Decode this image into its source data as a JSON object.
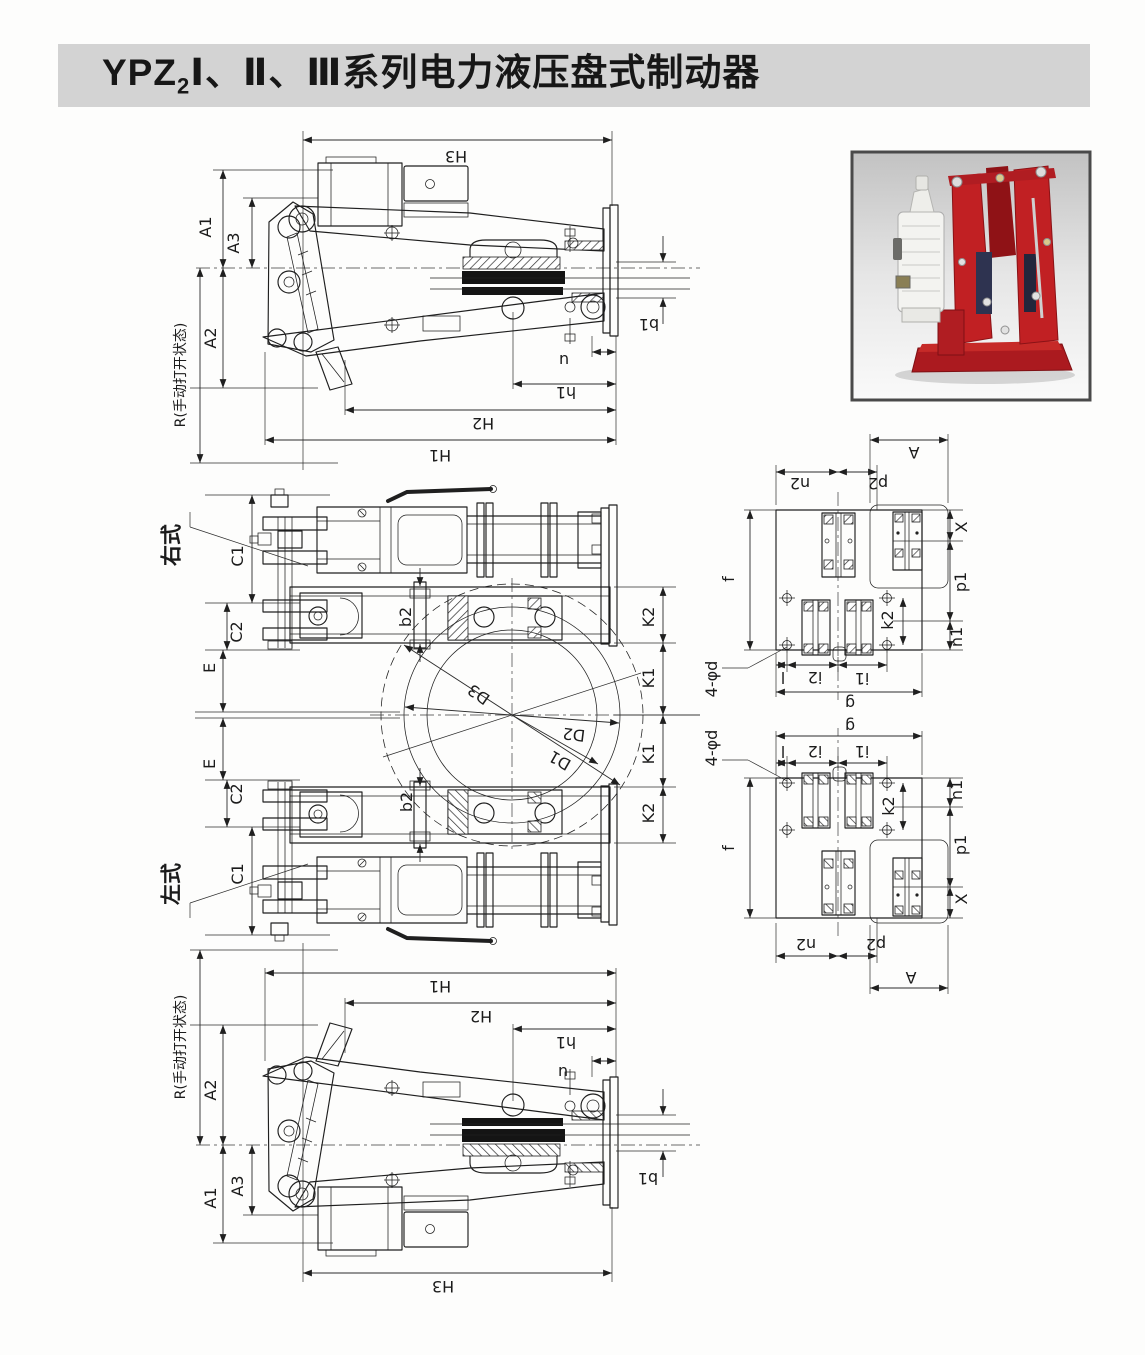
{
  "page": {
    "title_prefix": "YPZ",
    "title_sub": "2",
    "title_suffix": "Ⅰ、Ⅱ、Ⅲ系列电力液压盘式制动器"
  },
  "colors": {
    "title_bar_bg": "#d3d3d3",
    "line_color": "#2b2b2b",
    "brake_red": "#c12023",
    "photo_bg_top": "#c2c2c2"
  },
  "photo": {
    "description": "电力液压盘式制动器产品照片"
  },
  "labels": [
    {
      "t": "H3",
      "x": 456,
      "y": 156,
      "r": 180
    },
    {
      "t": "A1",
      "x": 206,
      "y": 227,
      "r": -90
    },
    {
      "t": "A3",
      "x": 234,
      "y": 243,
      "r": -90
    },
    {
      "t": "A2",
      "x": 211,
      "y": 338,
      "r": -90
    },
    {
      "t": "R(手动打开状态)",
      "x": 181,
      "y": 375,
      "r": -90,
      "s": 14
    },
    {
      "t": "b1",
      "x": 649,
      "y": 324,
      "r": 180
    },
    {
      "t": "u",
      "x": 564,
      "y": 360,
      "r": 180
    },
    {
      "t": "h1",
      "x": 566,
      "y": 392,
      "r": 180
    },
    {
      "t": "H2",
      "x": 483,
      "y": 423,
      "r": 180
    },
    {
      "t": "H1",
      "x": 440,
      "y": 455,
      "r": 180
    },
    {
      "t": "右式",
      "x": 172,
      "y": 545,
      "r": -90,
      "s": 21,
      "b": 1
    },
    {
      "t": "C1",
      "x": 238,
      "y": 556,
      "r": -90
    },
    {
      "t": "C2",
      "x": 237,
      "y": 632,
      "r": -90
    },
    {
      "t": "E",
      "x": 210,
      "y": 668,
      "r": -90
    },
    {
      "t": "b2",
      "x": 406,
      "y": 617,
      "r": -90
    },
    {
      "t": "K2",
      "x": 649,
      "y": 617,
      "r": -90
    },
    {
      "t": "K1",
      "x": 649,
      "y": 678,
      "r": -90
    },
    {
      "t": "D3",
      "x": 479,
      "y": 694,
      "r": 215
    },
    {
      "t": "D2",
      "x": 574,
      "y": 734,
      "r": 187
    },
    {
      "t": "D1",
      "x": 560,
      "y": 760,
      "r": 210
    },
    {
      "t": "K1",
      "x": 649,
      "y": 754,
      "r": -90
    },
    {
      "t": "K2",
      "x": 649,
      "y": 813,
      "r": -90
    },
    {
      "t": "E",
      "x": 210,
      "y": 764,
      "r": -90
    },
    {
      "t": "C2",
      "x": 237,
      "y": 794,
      "r": -90
    },
    {
      "t": "C1",
      "x": 238,
      "y": 874,
      "r": -90
    },
    {
      "t": "b2",
      "x": 407,
      "y": 802,
      "r": -90
    },
    {
      "t": "左式",
      "x": 172,
      "y": 884,
      "r": -90,
      "s": 21,
      "b": 1
    },
    {
      "t": "R(手动打开状态)",
      "x": 181,
      "y": 1047,
      "r": -90,
      "s": 14
    },
    {
      "t": "A2",
      "x": 211,
      "y": 1090,
      "r": -90
    },
    {
      "t": "A1",
      "x": 211,
      "y": 1198,
      "r": -90
    },
    {
      "t": "A3",
      "x": 238,
      "y": 1186,
      "r": -90
    },
    {
      "t": "H1",
      "x": 440,
      "y": 986,
      "r": 180
    },
    {
      "t": "H2",
      "x": 481,
      "y": 1016,
      "r": 180
    },
    {
      "t": "h1",
      "x": 566,
      "y": 1042,
      "r": 180
    },
    {
      "t": "u",
      "x": 563,
      "y": 1072,
      "r": 180
    },
    {
      "t": "b1",
      "x": 648,
      "y": 1178,
      "r": 180
    },
    {
      "t": "H3",
      "x": 443,
      "y": 1286,
      "r": 180
    },
    {
      "t": "n2",
      "x": 800,
      "y": 483,
      "r": 180
    },
    {
      "t": "p2",
      "x": 878,
      "y": 483,
      "r": 180
    },
    {
      "t": "A",
      "x": 914,
      "y": 452,
      "r": 180
    },
    {
      "t": "X",
      "x": 962,
      "y": 527,
      "r": -90
    },
    {
      "t": "p1",
      "x": 961,
      "y": 582,
      "r": -90
    },
    {
      "t": "n1",
      "x": 957,
      "y": 637,
      "r": -90
    },
    {
      "t": "f",
      "x": 729,
      "y": 579,
      "r": -90
    },
    {
      "t": "k2",
      "x": 888,
      "y": 620,
      "r": -90
    },
    {
      "t": "4-φd",
      "x": 712,
      "y": 679,
      "r": -90
    },
    {
      "t": "l",
      "x": 783,
      "y": 677,
      "r": 180
    },
    {
      "t": "i2",
      "x": 815,
      "y": 677,
      "r": 180
    },
    {
      "t": "i1",
      "x": 862,
      "y": 678,
      "r": 180
    },
    {
      "t": "g",
      "x": 850,
      "y": 703,
      "r": 180
    },
    {
      "t": "g",
      "x": 850,
      "y": 726,
      "r": 180
    },
    {
      "t": "l",
      "x": 783,
      "y": 751,
      "r": 180
    },
    {
      "t": "i2",
      "x": 815,
      "y": 751,
      "r": 180
    },
    {
      "t": "i1",
      "x": 862,
      "y": 751,
      "r": 180
    },
    {
      "t": "4-φd",
      "x": 712,
      "y": 748,
      "r": -90
    },
    {
      "t": "k2",
      "x": 889,
      "y": 806,
      "r": -90
    },
    {
      "t": "n1",
      "x": 957,
      "y": 790,
      "r": -90
    },
    {
      "t": "f",
      "x": 729,
      "y": 848,
      "r": -90
    },
    {
      "t": "p1",
      "x": 961,
      "y": 845,
      "r": -90
    },
    {
      "t": "X",
      "x": 962,
      "y": 899,
      "r": -90
    },
    {
      "t": "n2",
      "x": 806,
      "y": 944,
      "r": 180
    },
    {
      "t": "p2",
      "x": 876,
      "y": 944,
      "r": 180
    },
    {
      "t": "A",
      "x": 911,
      "y": 977,
      "r": 180
    }
  ]
}
